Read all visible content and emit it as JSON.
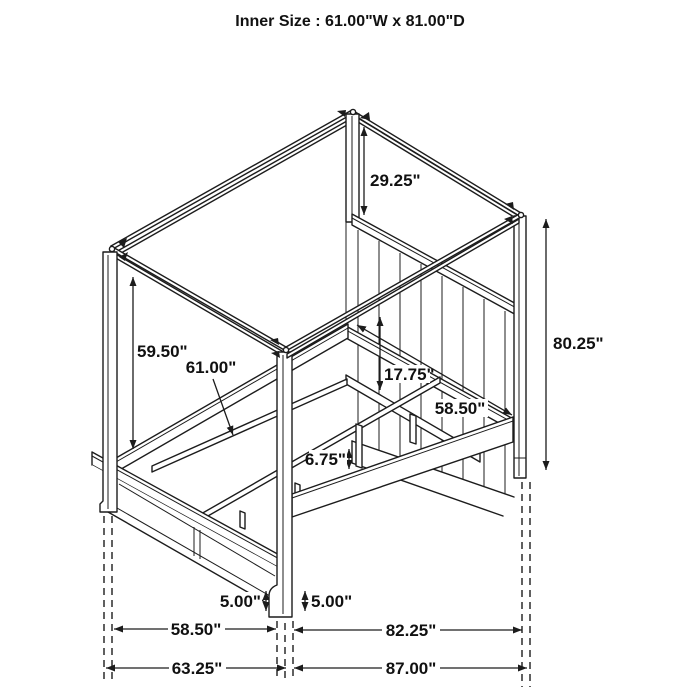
{
  "title": "Inner Size : 61.00\"W x 81.00\"D",
  "dimension_labels": {
    "canopy_to_headboard": "29.25\"",
    "post_height": "80.25\"",
    "canopy_to_siderail": "59.50\"",
    "inner_width": "61.00\"",
    "headboard_panel_height": "17.75\"",
    "frame_width": "58.50\"",
    "slat_leg_height": "6.75\"",
    "foot_height_left": "5.00\"",
    "foot_height_right": "5.00\"",
    "footboard_width": "58.50\"",
    "siderail_length": "82.25\"",
    "overall_width": "63.25\"",
    "overall_depth": "87.00\""
  },
  "colors": {
    "line": "#1c1c1c",
    "background": "#ffffff",
    "text": "#111111"
  }
}
